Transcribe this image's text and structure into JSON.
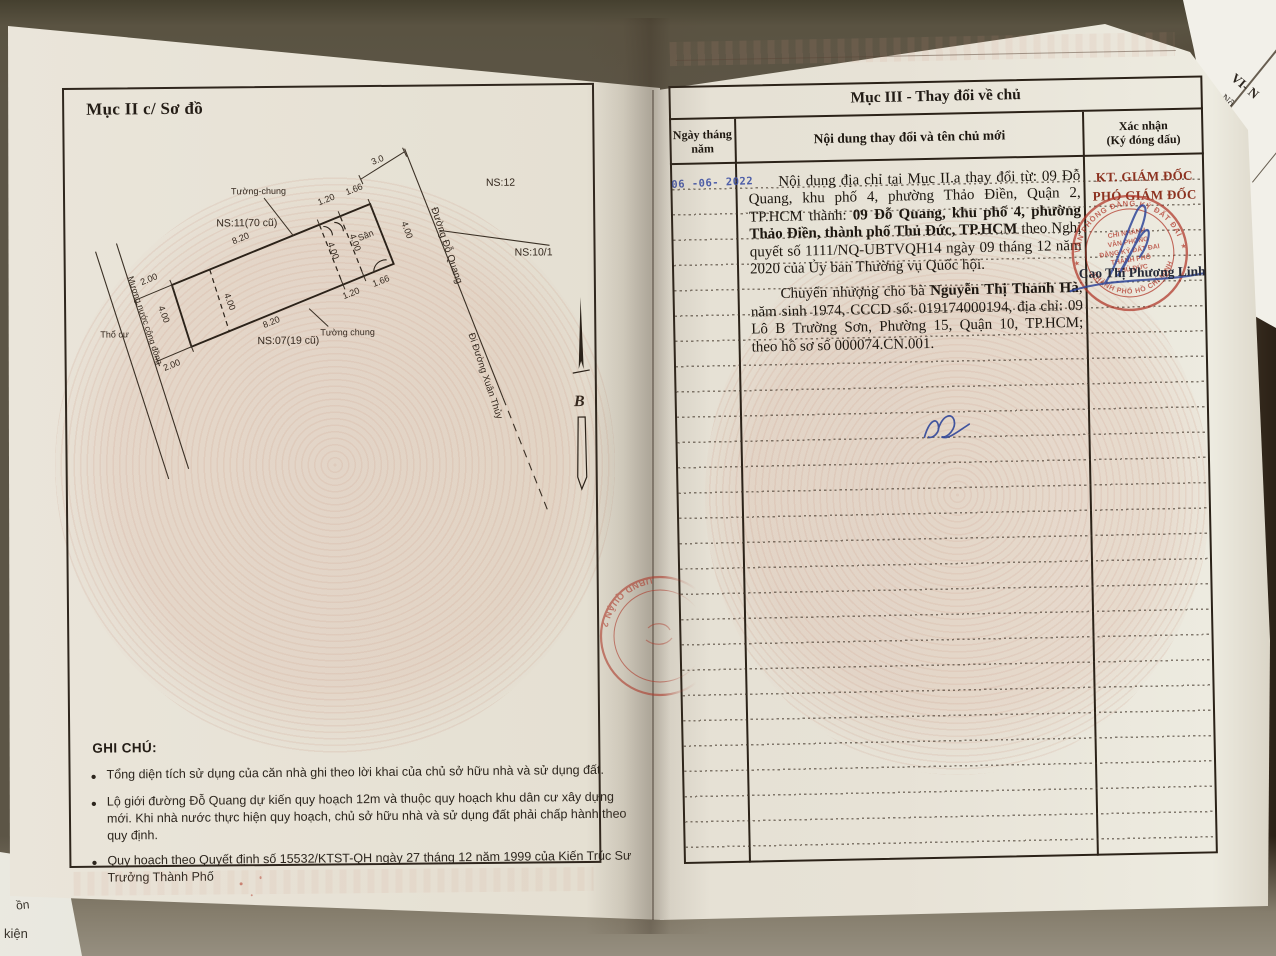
{
  "left_page": {
    "section_title": "Mục II c/ Sơ đồ",
    "diagram": {
      "ns11": "NS:11(70 cũ)",
      "ns07": "NS:07(19 cũ)",
      "ns12": "NS:12",
      "ns101": "NS:10/1",
      "tuong_chung_top": "Tường-chung",
      "tuong_chung_bottom": "Tường chung",
      "san": "Sân",
      "tho_cu": "Thổ cư",
      "muong": "Mương nước cộng đồng",
      "duong_do_quang": "Đường Đỗ Quang",
      "di_duong_xuan_thuy": "Đi Đường Xuân Thủy",
      "north": "B",
      "dim_820": "8.20",
      "dim_200": "2.00",
      "dim_400": "4.00",
      "dim_120": "1.20",
      "dim_166": "1.66",
      "dim_30": "3.0"
    },
    "notes": {
      "heading": "GHI CHÚ:",
      "items": [
        "Tổng diện tích sử dụng của căn nhà ghi theo lời khai của chủ sở hữu nhà và sử dụng đất.",
        "Lộ giới đường Đỗ Quang dự kiến quy hoạch 12m và thuộc quy hoạch khu dân cư xây dựng mới. Khi nhà nước thực hiện quy hoạch, chủ sở hữu nhà và sử dụng đất phải chấp hành theo quy định.",
        "Quy hoạch theo Quyết định số 15532/KTST-QH ngày 27 tháng 12 năm 1999 của Kiến Trúc Sư Trưởng Thành Phố"
      ]
    }
  },
  "right_page": {
    "section_title": "Mục III - Thay đổi về chủ",
    "table": {
      "col_date_line1": "Ngày tháng",
      "col_date_line2": "năm",
      "col_content": "Nội dung thay đổi và tên chủ mới",
      "col_confirm_line1": "Xác nhận",
      "col_confirm_line2": "(Ký đóng dấu)"
    },
    "entry": {
      "date_stamp": "06 -06- 2022",
      "p1_t1": "Nội dung địa chỉ tại Mục II.a thay đổi từ: 09 Đỗ Quang, khu phố 4, phường Thảo Điền, Quận 2, TP.HCM thành: ",
      "p1_b": "09 Đỗ Quang, khu phố 4, phường Thảo Điền, thành phố Thủ Đức, TP.HCM",
      "p1_t2": " theo Nghị quyết số 1111/NQ-UBTVQH14 ngày 09 tháng 12 năm 2020 của Ủy ban Thường vụ Quốc hội.",
      "p2_t1": "Chuyển nhượng cho bà ",
      "p2_b": "Nguyễn Thị Thanh Hà",
      "p2_t2": ", năm sinh 1974, CCCD số: 019174000194, địa chỉ: 09 Lô B Trường Sơn, Phường 15, Quận 10, TP.HCM; theo hồ sơ số 000074.CN.001."
    },
    "confirmation": {
      "title_line1": "KT. GIÁM ĐỐC",
      "title_line2": "PHÓ GIÁM ĐỐC",
      "signer": "Cao Thị Phương Linh",
      "stamp_ring_top": "VĂN PHÒNG ĐĂNG KÝ ĐẤT ĐAI",
      "stamp_ring_bottom": "THÀNH PHỐ HỒ CHÍ MINH",
      "stamp_center": [
        "CHI NHÁNH",
        "VĂN PHÒNG",
        "ĐĂNG KÝ ĐẤT ĐAI",
        "THÀNH PHỐ",
        "THỦ ĐỨC"
      ]
    }
  },
  "spine_stamp_text": "UBND QUẬN 2",
  "background_fragments": {
    "top_right_1": "VI- N",
    "top_right_2": "Nộ",
    "bottom_left_1": "ồn",
    "bottom_left_2": "kiện"
  },
  "colors": {
    "stamp_red": "#b23b2c",
    "stamp_blue": "#3f51a3",
    "ink": "#26201a",
    "page": "#e5e0d3"
  }
}
